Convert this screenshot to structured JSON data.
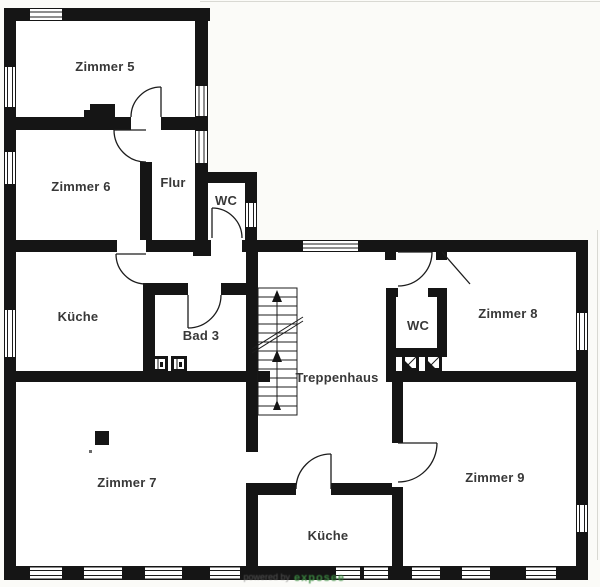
{
  "rooms": [
    {
      "id": "zimmer5",
      "label": "Zimmer 5"
    },
    {
      "id": "zimmer6",
      "label": "Zimmer 6"
    },
    {
      "id": "flur",
      "label": "Flur"
    },
    {
      "id": "wc-upper",
      "label": "WC"
    },
    {
      "id": "kueche-upper",
      "label": "Küche"
    },
    {
      "id": "bad3",
      "label": "Bad 3"
    },
    {
      "id": "treppenhaus",
      "label": "Treppenhaus"
    },
    {
      "id": "wc-right",
      "label": "WC"
    },
    {
      "id": "zimmer8",
      "label": "Zimmer 8"
    },
    {
      "id": "zimmer7",
      "label": "Zimmer 7"
    },
    {
      "id": "zimmer9",
      "label": "Zimmer 9"
    },
    {
      "id": "kueche-lower",
      "label": "Küche"
    }
  ],
  "watermark": {
    "prefix": "powered by",
    "brand": "exposee",
    "color": "#3d8f43"
  },
  "colors": {
    "wall": "#151515",
    "background": "#fbfbf8",
    "label": "#383838"
  }
}
